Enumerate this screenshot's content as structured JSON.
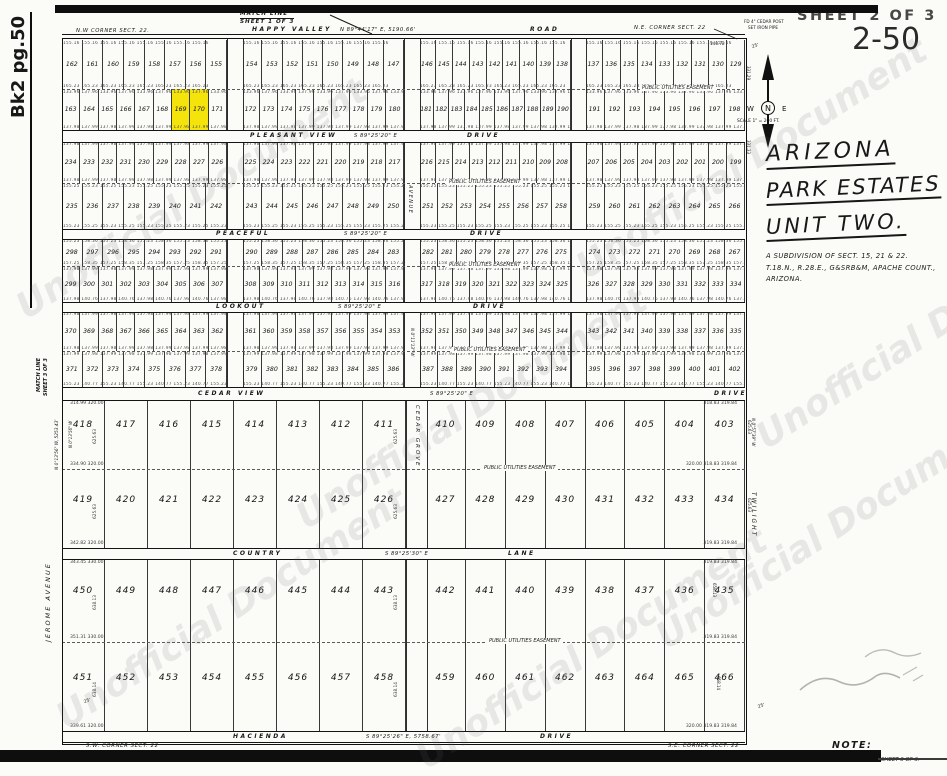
{
  "page": {
    "watermark": "Unofficial Document",
    "book_ref": "Bk2 pg.50",
    "sheet_label": "SHEET 2 OF 3",
    "page_number": "2-50"
  },
  "title_block": {
    "line1": "ARIZONA",
    "line2": "PARK ESTATES",
    "line3": "UNIT TWO.",
    "sub1": "A SUBDIVISION OF SECT. 15, 21 & 22.",
    "sub2": "T.18.N., R.28.E., G&SRB&M, APACHE COUNT.,",
    "sub3": "ARIZONA."
  },
  "compass": {
    "n": "N",
    "w": "W",
    "e": "E",
    "scale": "SCALE 1\" = 200 FT."
  },
  "top": {
    "match1": "MATCH LINE",
    "match2": "SHEET 1 OF 3",
    "nw_corner": "N.W CORNER SECT. 22.",
    "road_name": "HAPPY VALLEY",
    "road_bearing": "N 89°44'17\" E, 5190.66'",
    "road_suffix": "ROAD",
    "ne_corner": "N.E. CORNER SECT. 22",
    "ne_note1": "FD 4\" CEDAR POST",
    "ne_note2": "SET IRON PIPE",
    "dim": "140.72",
    "tick": "25'"
  },
  "left_edge": {
    "match1": "MATCH LINE",
    "match2": "SHEET 3 OF 3",
    "bearing": "N 0°13'56\" W, 5253.43'",
    "bearing2": "N 0°13'56\" W",
    "street": "JEROME  AVENUE"
  },
  "right_edge": {
    "street": "TWILIGHT",
    "bearing": "N 0°57'39\" W",
    "dims": [
      "331.29",
      "331.33",
      "625.63",
      "625.63",
      "658.13",
      "658.14"
    ],
    "tick_se": "25'"
  },
  "streets": {
    "pleasant_view": {
      "name": "PLEASANT VIEW",
      "bearing": "S 89°25'20\" E",
      "suffix": "DRIVE"
    },
    "peaceful": {
      "name": "PEACEFUL",
      "bearing": "S 89°25'20\" E",
      "suffix": "DRIVE"
    },
    "lookout": {
      "name": "LOOKOUT",
      "bearing": "S 89°25'20\" E",
      "suffix": "DRIVE"
    },
    "cedar_view": {
      "name": "CEDAR VIEW",
      "bearing": "S 89°25'20\" E",
      "suffix": "DRIVE"
    },
    "country": {
      "name": "COUNTRY",
      "bearing": "S 89°25'30\" E",
      "suffix": "LANE"
    },
    "hacienda": {
      "name": "HACIENDA",
      "bearing": "S 89°25'26\" E, 5758.67'",
      "suffix": "DRIVE"
    },
    "avenue_vertical": {
      "name": "AVENUE",
      "bearing": "N 0°11'13\" W"
    },
    "cedar_grove_vertical": {
      "name": "CEDAR GROVE"
    }
  },
  "easement_label": "PUBLIC UTILITIES EASEMENT",
  "bottom": {
    "sw_corner": "S.W. CORNER SECT. 22",
    "se_corner": "S.E. CORNER SECT. 22",
    "tick": "25'"
  },
  "note": {
    "heading": "NOTE:",
    "body": "FOR CERTIFICATE OF SURVEY SEE SHEET 3 OF 3."
  },
  "highlight": {
    "lots": [
      169,
      170
    ],
    "color": "#F5E40B"
  },
  "upper_rows": [
    {
      "id": "r1",
      "segments": [
        [
          162,
          161,
          160,
          159,
          158,
          157,
          156,
          155
        ],
        [
          154,
          153,
          152,
          151,
          150,
          149,
          148,
          147
        ],
        [
          146,
          145,
          144,
          143,
          142,
          141,
          140,
          139,
          138
        ],
        [
          137,
          136,
          135,
          134,
          133,
          132,
          131,
          130,
          129
        ]
      ],
      "dim_top": "155.16",
      "dim_bottom": "165.23"
    },
    {
      "id": "r2",
      "segments": [
        [
          163,
          164,
          165,
          166,
          167,
          168,
          169,
          170,
          171
        ],
        [
          172,
          173,
          174,
          175,
          176,
          177,
          178,
          179,
          180
        ],
        [
          181,
          182,
          183,
          184,
          185,
          186,
          187,
          188,
          189,
          190
        ],
        [
          191,
          192,
          193,
          194,
          195,
          196,
          197,
          198
        ]
      ],
      "dim_top": "133.96  137.96",
      "dim_bottom": "137.98  137.99"
    },
    {
      "id": "r3",
      "segments": [
        [
          234,
          233,
          232,
          231,
          230,
          229,
          228,
          227,
          226
        ],
        [
          225,
          224,
          223,
          222,
          221,
          220,
          219,
          218,
          217
        ],
        [
          216,
          215,
          214,
          213,
          212,
          211,
          210,
          209,
          208
        ],
        [
          207,
          206,
          205,
          204,
          203,
          202,
          201,
          200,
          199
        ]
      ],
      "dim_top": "137.98  137.99",
      "dim_bottom": "137.98  137.99"
    },
    {
      "id": "r4",
      "segments": [
        [
          235,
          236,
          237,
          238,
          239,
          240,
          241,
          242
        ],
        [
          243,
          244,
          245,
          246,
          247,
          248,
          249,
          250
        ],
        [
          251,
          252,
          253,
          254,
          255,
          256,
          257,
          258
        ],
        [
          259,
          260,
          261,
          262,
          263,
          264,
          265,
          266
        ]
      ],
      "dim_top": "155.25  155.23",
      "dim_bottom": "155.23  155.25"
    },
    {
      "id": "r5",
      "segments": [
        [
          298,
          297,
          296,
          295,
          294,
          293,
          292,
          291
        ],
        [
          290,
          289,
          288,
          287,
          286,
          285,
          284,
          283
        ],
        [
          282,
          281,
          280,
          279,
          278,
          277,
          276,
          275
        ],
        [
          274,
          273,
          272,
          271,
          270,
          269,
          268,
          267
        ]
      ],
      "dim_top": "155.23  158.36",
      "dim_bottom": "157.25  158.35"
    },
    {
      "id": "r6",
      "segments": [
        [
          299,
          300,
          301,
          302,
          303,
          304,
          305,
          306,
          307
        ],
        [
          308,
          309,
          310,
          311,
          312,
          313,
          314,
          315,
          316
        ],
        [
          317,
          318,
          319,
          320,
          321,
          322,
          323,
          324,
          325
        ],
        [
          326,
          327,
          328,
          329,
          330,
          331,
          332,
          333,
          334
        ]
      ],
      "dim_top": "137.98  137.99",
      "dim_bottom": "137.98  140.76"
    },
    {
      "id": "r7",
      "segments": [
        [
          370,
          369,
          368,
          367,
          366,
          365,
          364,
          363,
          362
        ],
        [
          361,
          360,
          359,
          358,
          357,
          356,
          355,
          354,
          353
        ],
        [
          352,
          351,
          350,
          349,
          348,
          347,
          346,
          345,
          344
        ],
        [
          343,
          342,
          341,
          340,
          339,
          338,
          337,
          336,
          335
        ]
      ],
      "dim_top": "137.98  137.99",
      "dim_bottom": "137.98  137.99"
    },
    {
      "id": "r8",
      "segments": [
        [
          371,
          372,
          373,
          374,
          375,
          376,
          377,
          378
        ],
        [
          379,
          380,
          381,
          382,
          383,
          384,
          385,
          386
        ],
        [
          387,
          388,
          389,
          390,
          391,
          392,
          393,
          394
        ],
        [
          395,
          396,
          397,
          398,
          399,
          400,
          401,
          402
        ]
      ],
      "dim_top": "137.99  137.98",
      "dim_bottom": "155.23  140.77"
    }
  ],
  "lower_rows": [
    {
      "id": "r9",
      "segments": [
        [
          418,
          417,
          416,
          415,
          414,
          413,
          412,
          411
        ],
        [
          410,
          409,
          408,
          407,
          406,
          405,
          404,
          403
        ]
      ],
      "dim_top_left": "314.99   320.00",
      "dim_top_right": "318.83   319.84",
      "dim_bottom_left": "334.90   320.00",
      "dim_bottom_right": "320.00   318.83   319.84",
      "side_dim": "625.63"
    },
    {
      "id": "r10",
      "segments": [
        [
          419,
          420,
          421,
          422,
          423,
          424,
          425,
          426
        ],
        [
          427,
          428,
          429,
          430,
          431,
          432,
          433,
          434
        ]
      ],
      "dim_bottom_left": "342.82   320.00",
      "dim_bottom_right": "319.83   319.84",
      "side_dim": "625.63"
    },
    {
      "id": "r11",
      "segments": [
        [
          450,
          449,
          448,
          447,
          446,
          445,
          444,
          443
        ],
        [
          442,
          441,
          440,
          439,
          438,
          437,
          436,
          435
        ]
      ],
      "dim_top_left": "343.45   330.00",
      "dim_top_right": "319.83   319.84",
      "dim_bottom_left": "351.31   330.00",
      "dim_bottom_right": "319.83   319.84",
      "side_dim": "638.13"
    },
    {
      "id": "r12",
      "segments": [
        [
          451,
          452,
          453,
          454,
          455,
          456,
          457,
          458
        ],
        [
          459,
          460,
          461,
          462,
          463,
          464,
          465,
          466
        ]
      ],
      "dim_bottom_left": "339.61   320.00",
      "dim_bottom_right": "320.00   319.83   319.84",
      "side_dim": "638.14"
    }
  ]
}
